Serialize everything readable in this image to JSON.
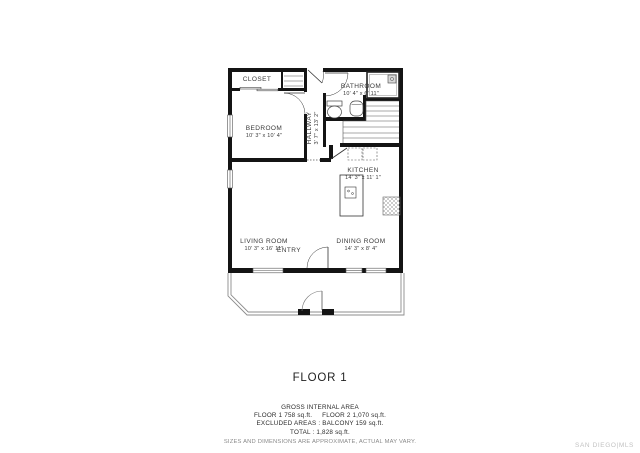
{
  "floor_plan": {
    "title": "FLOOR 1",
    "rooms": {
      "closet": {
        "name": "CLOSET",
        "dims": ""
      },
      "bathroom": {
        "name": "BATHROOM",
        "dims": "10' 4\" x 6' 11\""
      },
      "bedroom": {
        "name": "BEDROOM",
        "dims": "10' 3\" x 10' 4\""
      },
      "hallway": {
        "name": "HALLWAY",
        "dims": "3' 7\" x 13' 2\""
      },
      "kitchen": {
        "name": "KITCHEN",
        "dims": "14' 3\" x 11' 1\""
      },
      "living_room": {
        "name": "LIVING ROOM",
        "dims": "10' 3\" x 16' 11\""
      },
      "entry": {
        "name": "ENTRY",
        "dims": ""
      },
      "dining_room": {
        "name": "DINING ROOM",
        "dims": "14' 3\" x 8' 4\""
      }
    }
  },
  "footer": {
    "area_title": "GROSS INTERNAL AREA",
    "floor1_area": "FLOOR 1 758 sq.ft.",
    "floor2_area": "FLOOR 2 1,070 sq.ft.",
    "excluded_line": "EXCLUDED AREAS :  BALCONY 159 sq.ft.",
    "total_line": "TOTAL :  1,828 sq.ft.",
    "disclaimer": "SIZES AND DIMENSIONS ARE APPROXIMATE, ACTUAL MAY VARY."
  },
  "watermark": {
    "brand": "SAN DIEGO|MLS"
  },
  "colors": {
    "wall": "#141414",
    "text": "#3a3a3a",
    "muted": "#8a8a8a",
    "watermark": "#c2c2c2"
  }
}
